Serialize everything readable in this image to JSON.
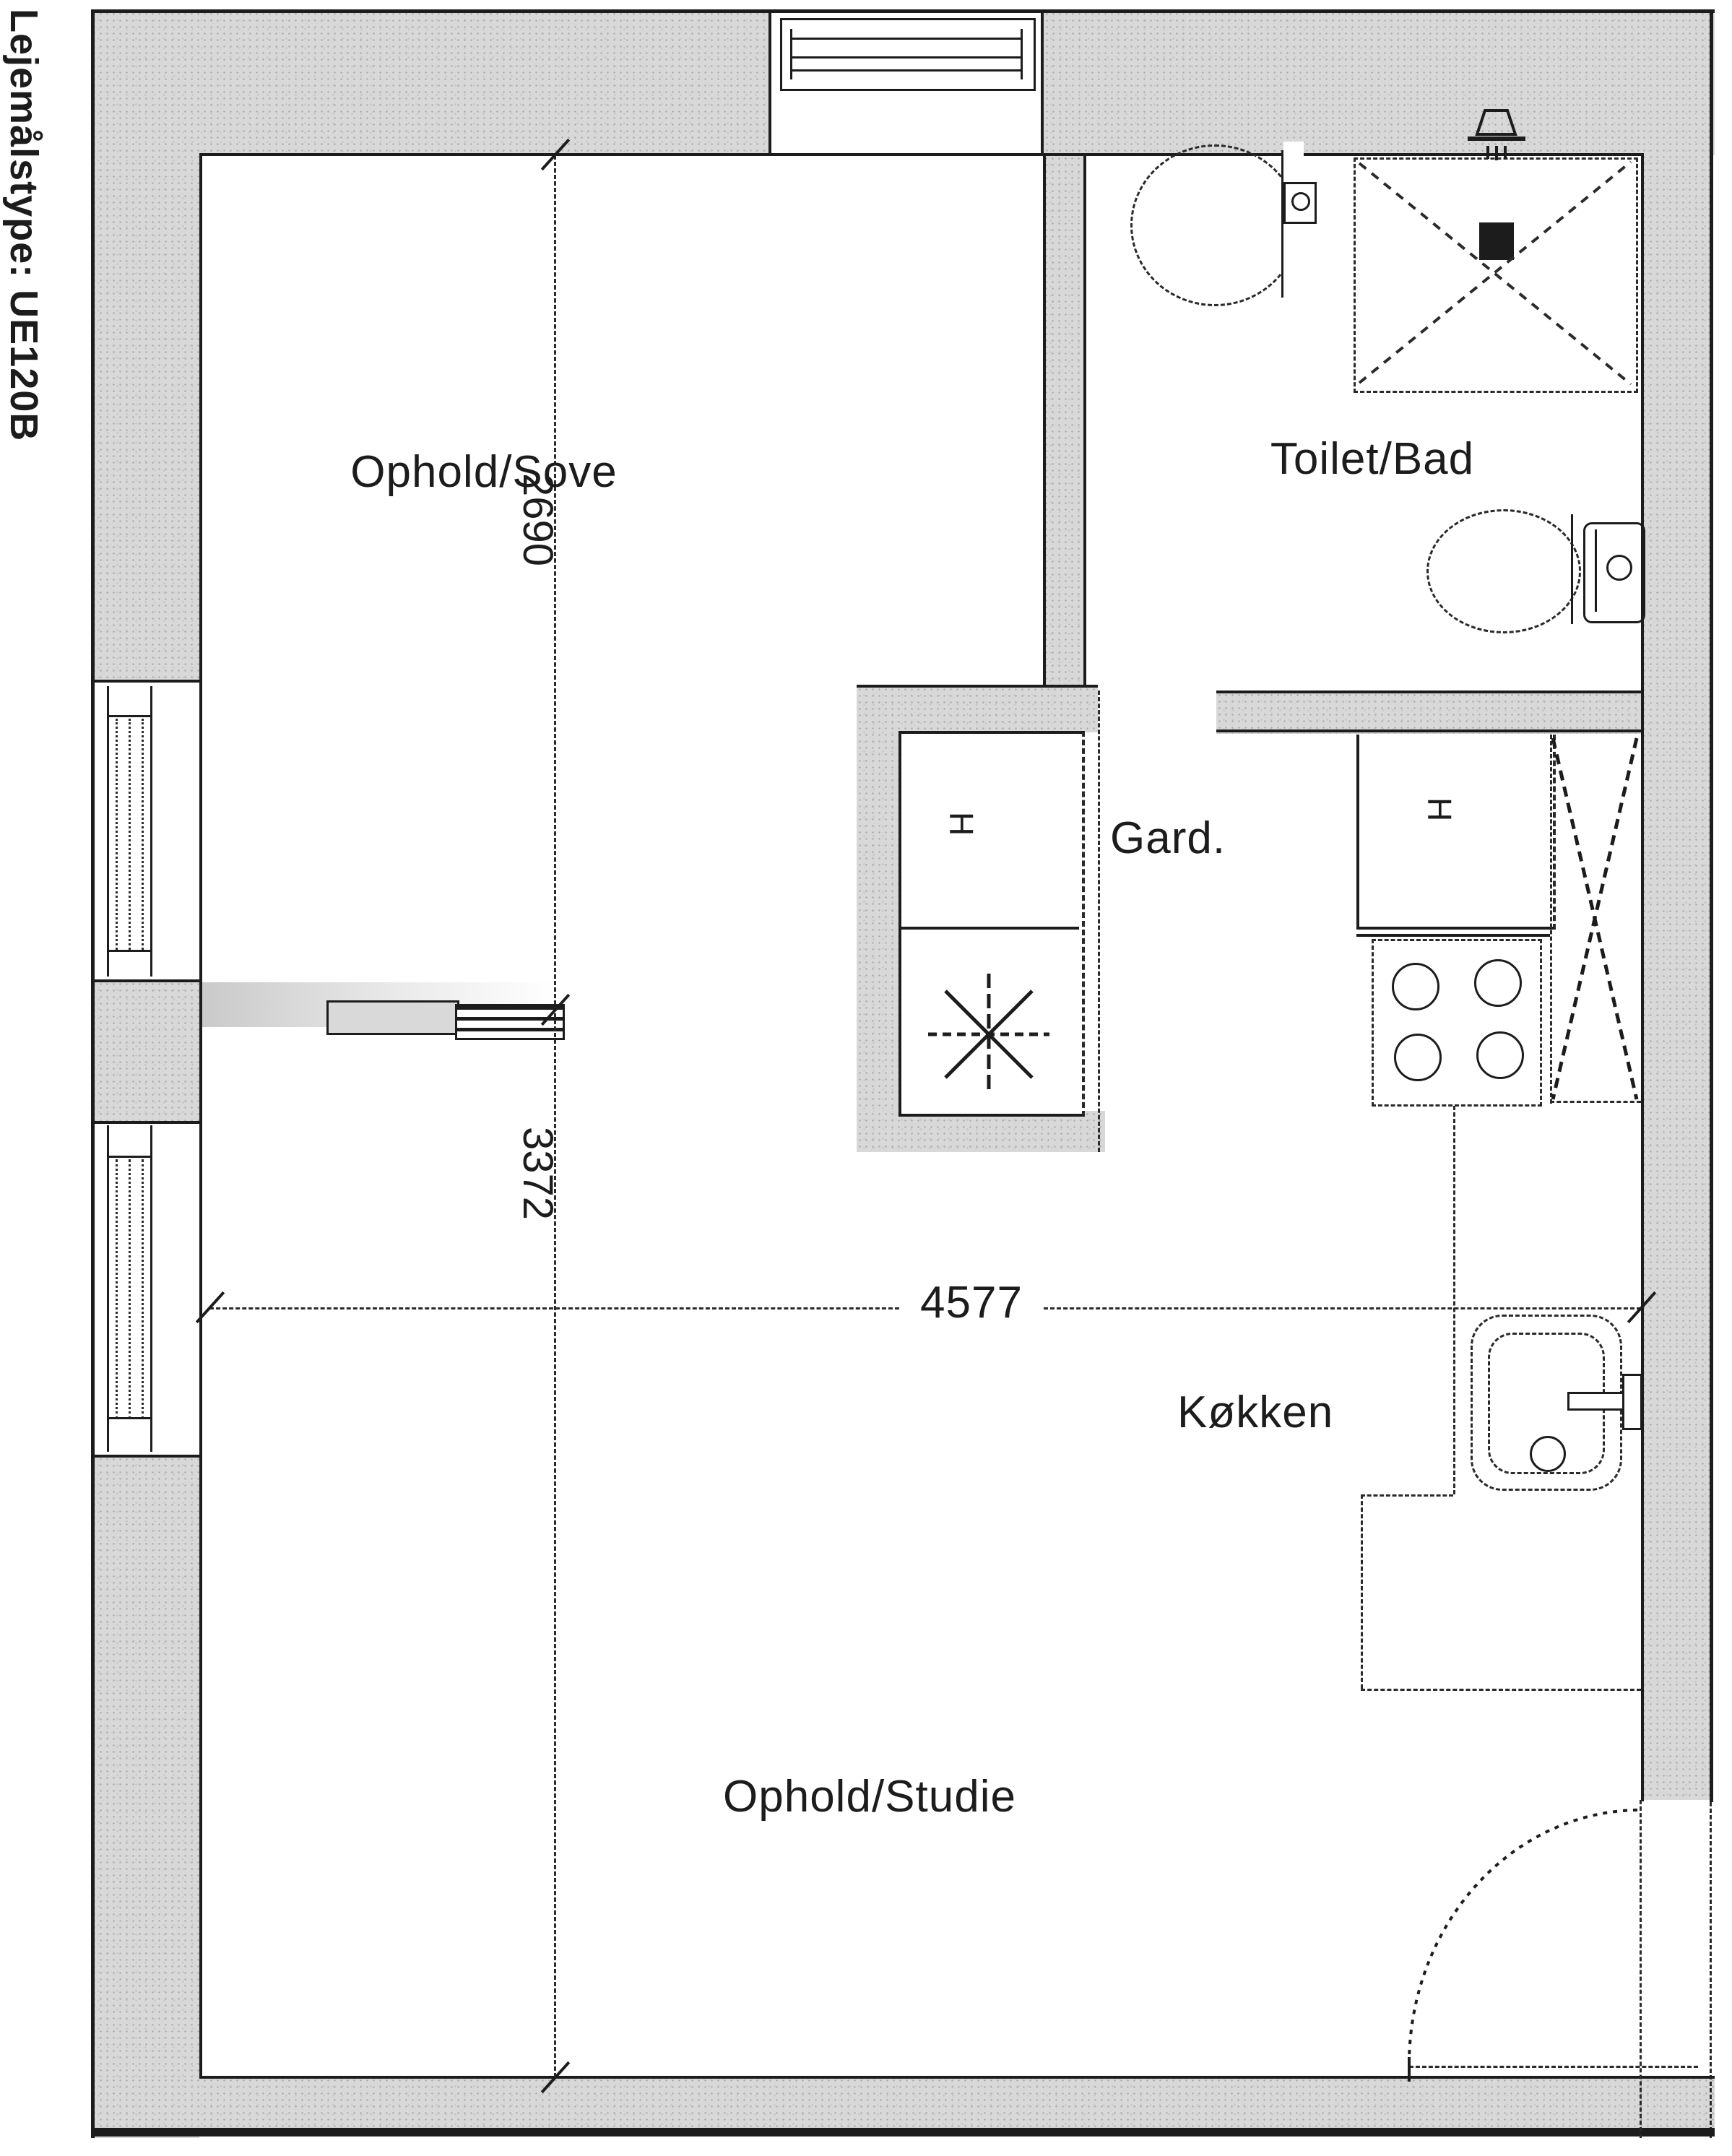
{
  "title": {
    "label": "Lejemålstype: UE120B"
  },
  "rooms": {
    "living_sleep": "Ophold/Sove",
    "bathroom": "Toilet/Bad",
    "wardrobe": "Gard.",
    "kitchen": "Køkken",
    "living_study": "Ophold/Studie"
  },
  "dimensions": {
    "upper_height_mm": "2690",
    "lower_height_mm": "3372",
    "width_mm": "4577"
  },
  "symbols": {
    "cabinet_marker_wardrobe": "H",
    "cabinet_marker_kitchen": "H"
  },
  "colors": {
    "wall_fill": "#d8d8d8",
    "line": "#1c1c1c",
    "paper": "#ffffff"
  }
}
